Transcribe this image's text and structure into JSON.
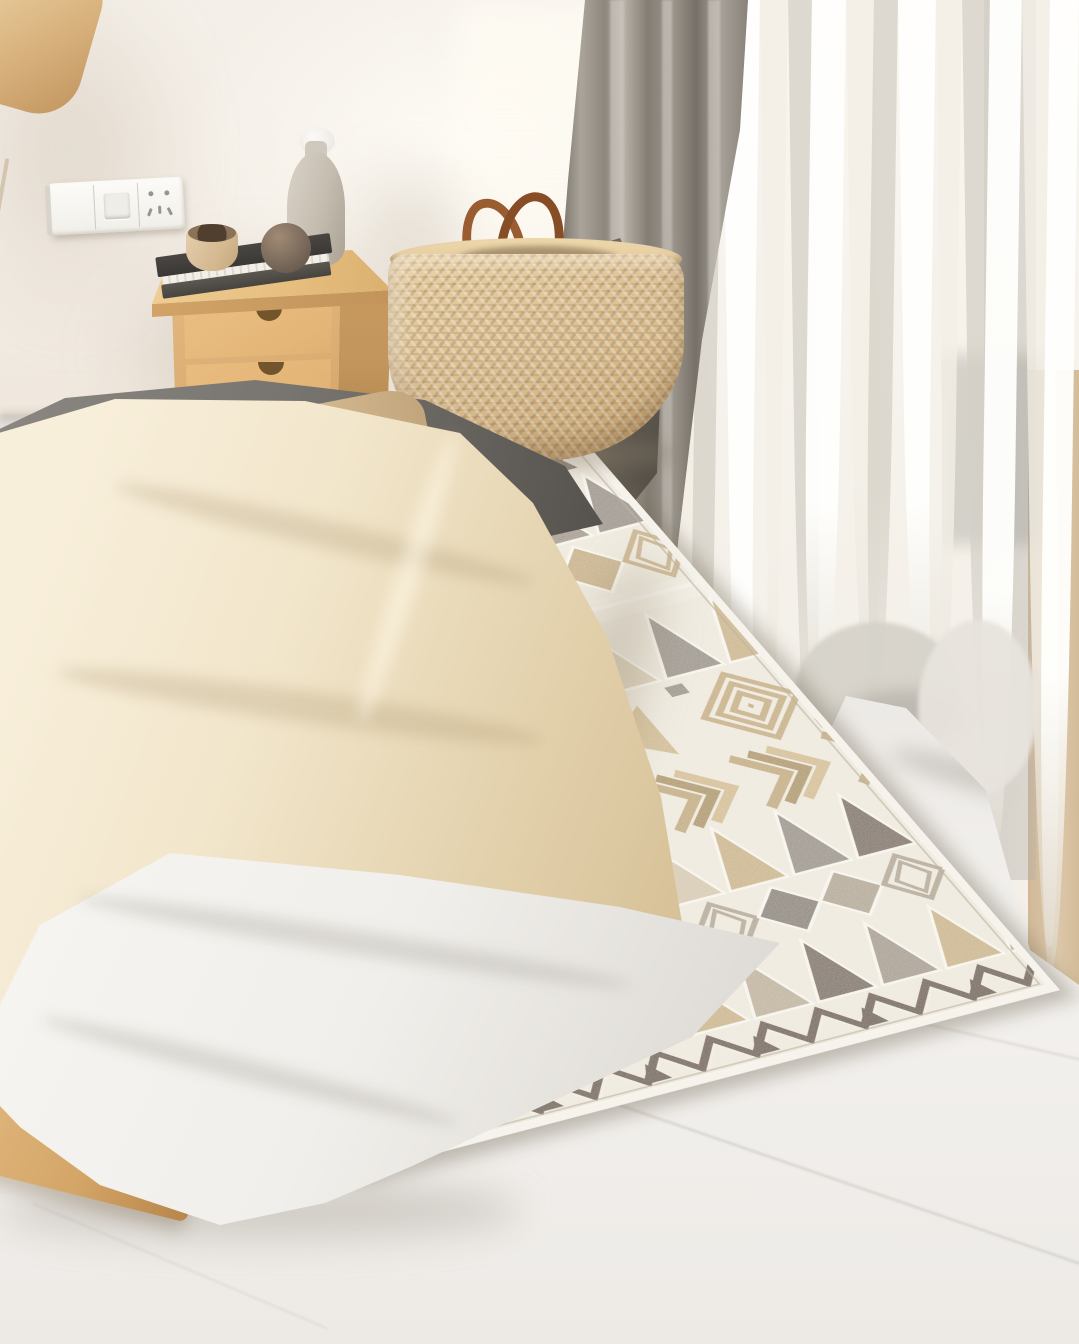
{
  "scene": {
    "description": "Sunlit bedroom corner: bed with cream duvet, wooden nightstand with decor, woven basket, gray and sheer curtains, and a bohemian geometric area rug on a light marble floor",
    "palette": {
      "wall": "#f4efe8",
      "wallShade": "#efe7dc",
      "floor": "#e9e6e2",
      "floorLight": "#f3f1ee",
      "wood": "#ddb077",
      "woodDark": "#c2955c",
      "woodLight": "#f0cf96",
      "rugCream": "#ebe5d8",
      "rugWhite": "#f6f3ec",
      "curtainGray": "#968f86",
      "curtainGrayDark": "#6f6961",
      "sheer": "#f6f3ec",
      "tanBand": "#d9c2a2",
      "basket": "#d9bd90",
      "handle": "#94582e",
      "duvet": "#f2e6cb",
      "sheet": "#f1efeb",
      "pillowGray": "#75716c",
      "bedWood": "#d3a567"
    },
    "rug": {
      "width": 750,
      "height": 780,
      "background": "#ebe5d8",
      "edgeWhite": "#f6f3ec",
      "gapStroke": "#f5f2ea",
      "rows": [
        {
          "type": "edge",
          "h": 8
        },
        {
          "type": "zig",
          "h": 42,
          "colors": [
            "#6a5b4d",
            "#f0ece2"
          ]
        },
        {
          "type": "tris",
          "h": 80,
          "colors": [
            "#8d847b",
            "#c3a97c",
            "#6e6156",
            "#d8cab0",
            "#978a7e"
          ]
        },
        {
          "type": "diamonds",
          "h": 72,
          "colors": [
            "#8d847b",
            "#bfa478",
            "#a39786"
          ]
        },
        {
          "type": "plain",
          "h": 28,
          "colors": [
            "#efe9dd"
          ]
        },
        {
          "type": "tris",
          "h": 88,
          "colors": [
            "#6e6156",
            "#d5c7ac",
            "#8d847b",
            "#c3a97c"
          ]
        },
        {
          "type": "motifs",
          "h": 106,
          "colors": [
            "#bda273",
            "#c9b183",
            "#8d847b",
            "#6a5b4d"
          ]
        },
        {
          "type": "chev",
          "h": 72,
          "colors": [
            "#b99e70",
            "#a28859",
            "#cdb385"
          ]
        },
        {
          "type": "tris",
          "h": 86,
          "colors": [
            "#c3a97c",
            "#8d847b",
            "#6e6156",
            "#cfc1a6"
          ]
        },
        {
          "type": "diamonds",
          "h": 70,
          "colors": [
            "#7d746b",
            "#a89b88",
            "#8d847b"
          ]
        },
        {
          "type": "tris",
          "h": 84,
          "colors": [
            "#6e6156",
            "#9a8e82",
            "#c3a97c",
            "#b5a78f"
          ]
        },
        {
          "type": "zig",
          "h": 46,
          "colors": [
            "#5f5146",
            "#efe9dd"
          ]
        },
        {
          "type": "edge",
          "h": 10
        }
      ]
    },
    "sheer": {
      "bottomProfile": [
        [
          0,
          1012
        ],
        [
          50,
          1008
        ],
        [
          150,
          860
        ],
        [
          246,
          700
        ],
        [
          306,
          712
        ],
        [
          388,
          792
        ],
        [
          432,
          950
        ],
        [
          479,
          985
        ]
      ],
      "tones": {
        "bright": "rgba(255,255,253,0.95)",
        "light": "rgba(243,239,231,0.8)",
        "dark": "rgba(213,208,198,0.75)"
      },
      "folds": [
        {
          "x": 16,
          "w": 28,
          "tone": "dark"
        },
        {
          "x": 44,
          "w": 24,
          "tone": "bright"
        },
        {
          "x": 68,
          "w": 32,
          "tone": "light"
        },
        {
          "x": 100,
          "w": 22,
          "tone": "dark"
        },
        {
          "x": 122,
          "w": 38,
          "tone": "bright"
        },
        {
          "x": 160,
          "w": 28,
          "tone": "light"
        },
        {
          "x": 188,
          "w": 24,
          "tone": "dark"
        },
        {
          "x": 212,
          "w": 34,
          "tone": "bright"
        },
        {
          "x": 246,
          "w": 28,
          "tone": "light"
        },
        {
          "x": 274,
          "w": 24,
          "tone": "dark"
        },
        {
          "x": 298,
          "w": 38,
          "tone": "bright"
        },
        {
          "x": 336,
          "w": 26,
          "tone": "light"
        },
        {
          "x": 362,
          "w": 28,
          "tone": "dark"
        },
        {
          "x": 390,
          "w": 32,
          "tone": "bright"
        },
        {
          "x": 422,
          "w": 28,
          "tone": "light"
        },
        {
          "x": 450,
          "w": 29,
          "tone": "bright"
        }
      ]
    }
  }
}
